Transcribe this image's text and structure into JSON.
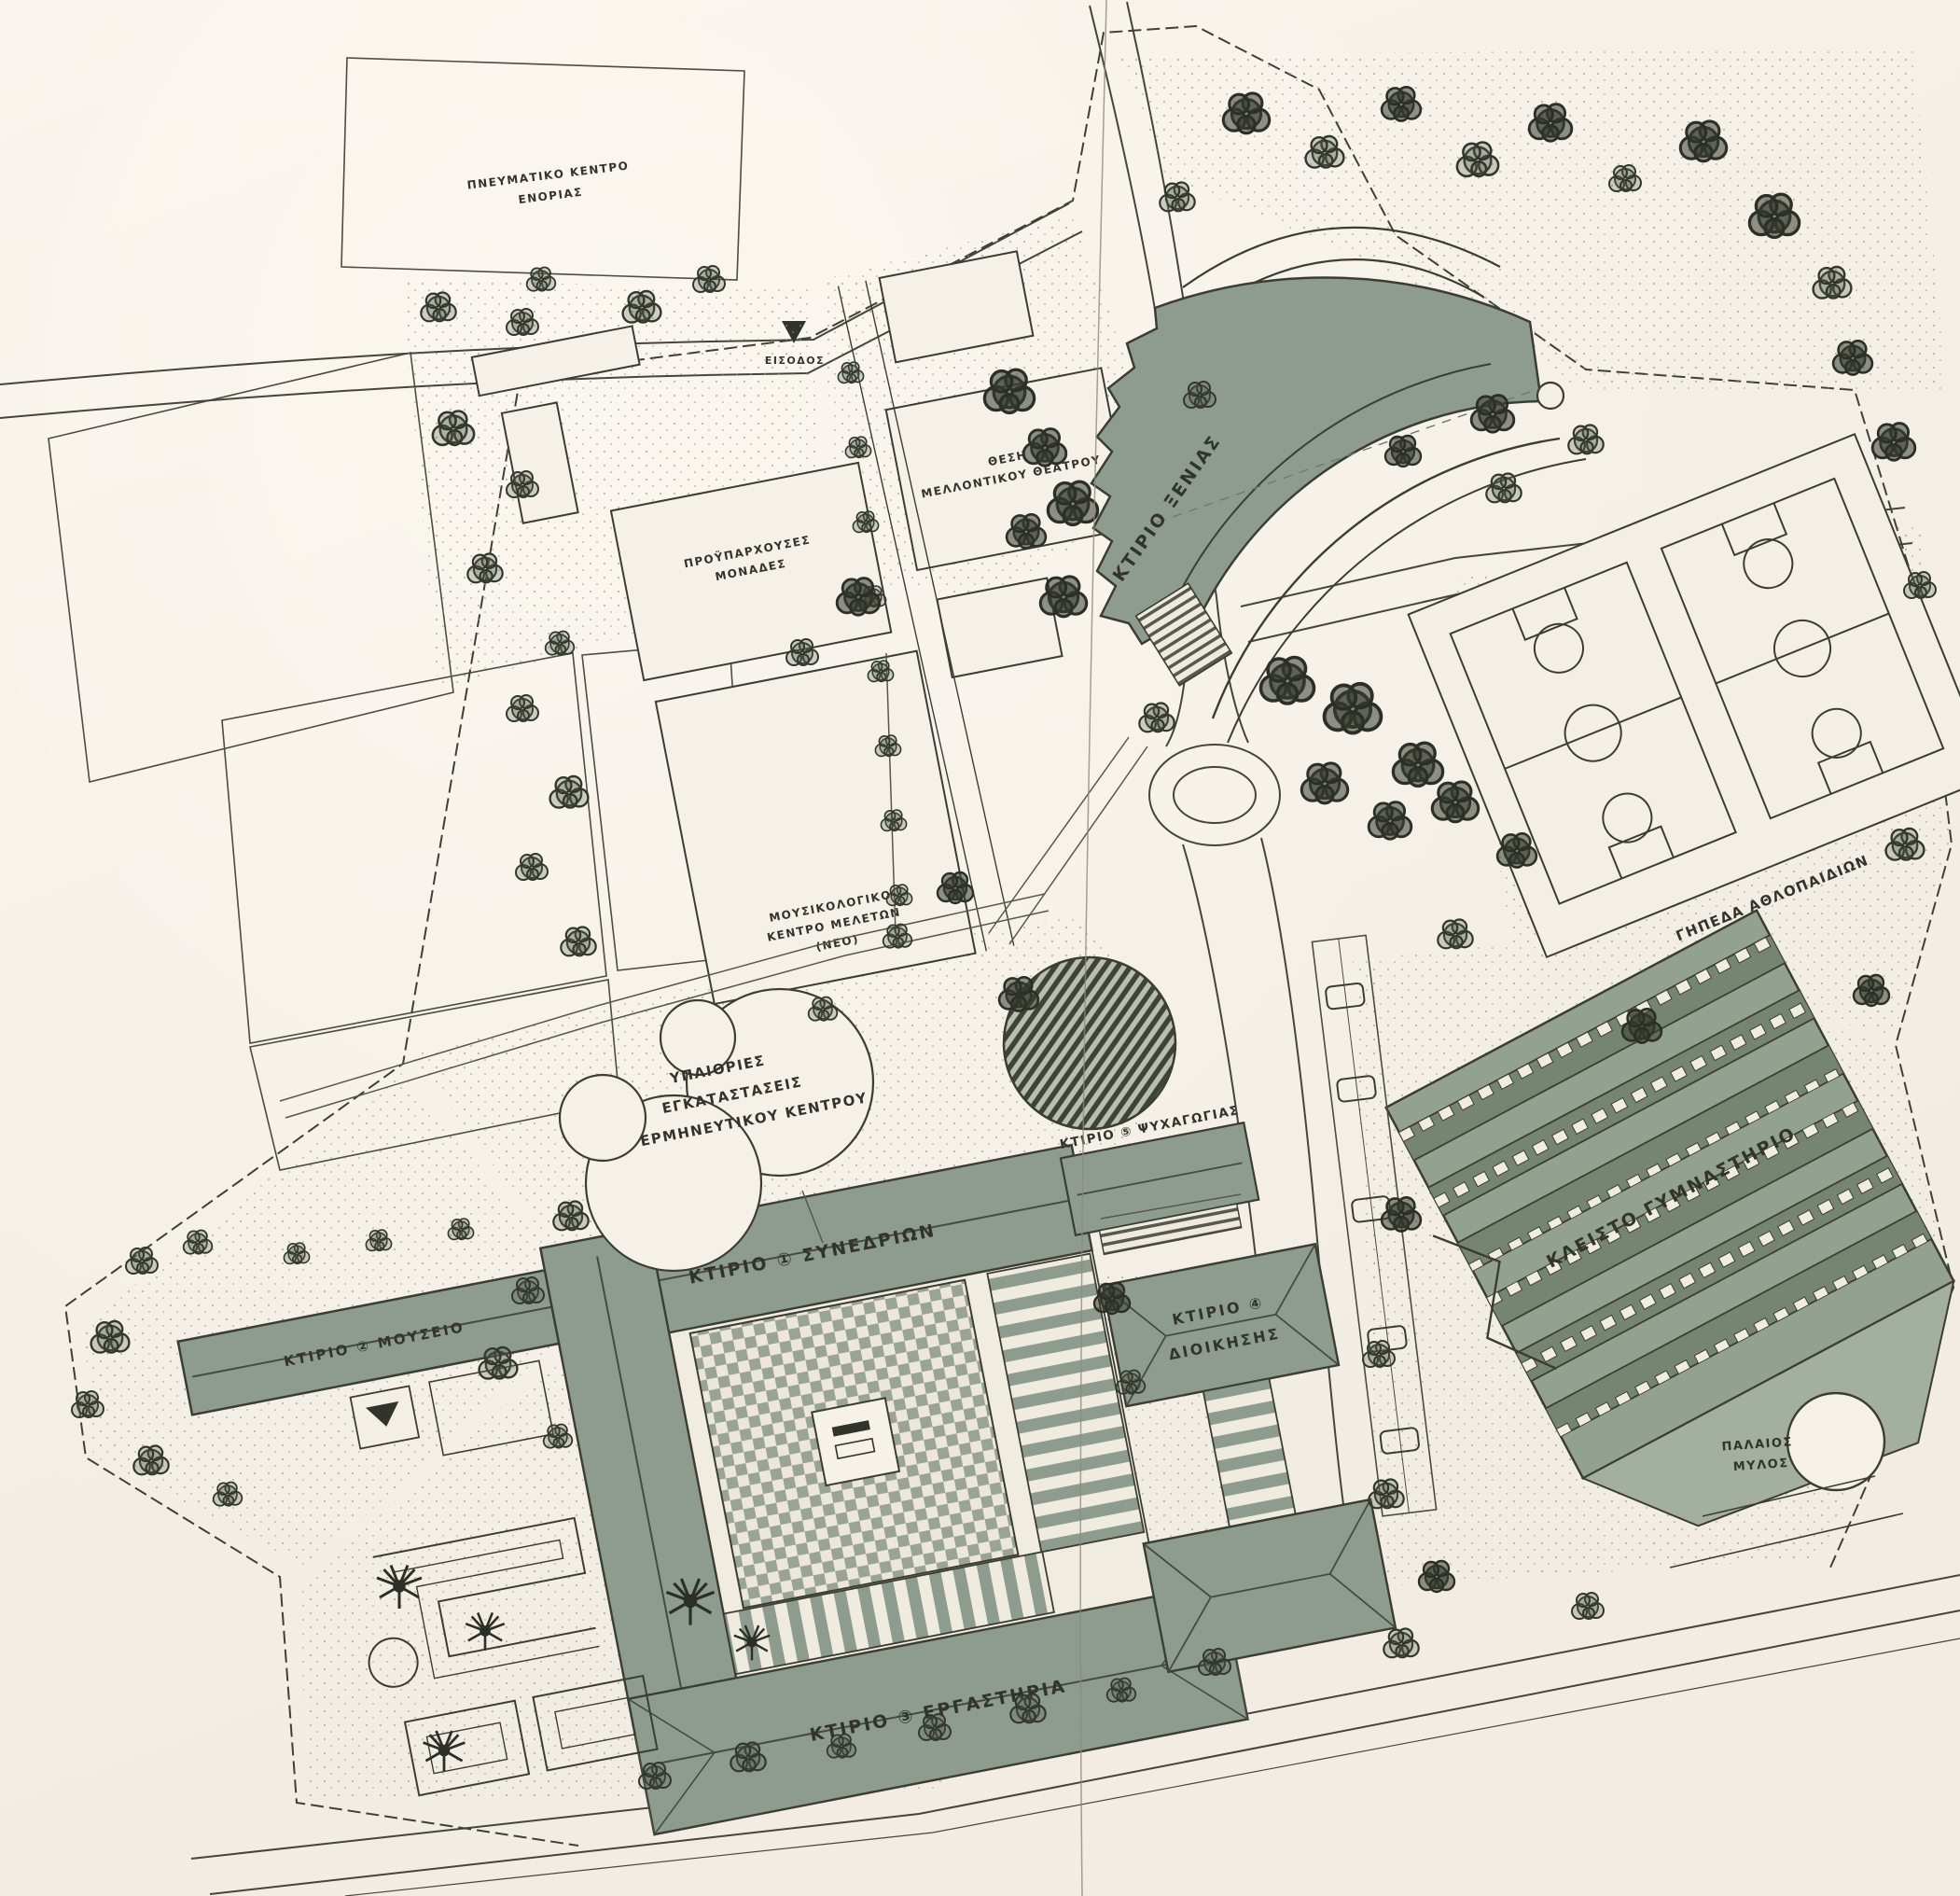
{
  "document": {
    "type": "architectural-site-plan-scan",
    "orientation_note": "campus master plan, buildings rotated ~-11deg"
  },
  "palette": {
    "paper": "#f5f0e7",
    "ink": "#3b3d33",
    "roof_sage": "#8e9c90",
    "roof_sage_dark": "#76856f",
    "roof_sage_light": "#a3af9f",
    "plaza_light": "#ece7da",
    "stipple": "#8d9286"
  },
  "plan": {
    "labels": {
      "xenia": "ΚΤΙΡΙΟ ΞΕΝΙΑΣ",
      "museum": "ΚΤΙΡΙΟ ② ΜΟΥΣΕΙΟ",
      "conference": "ΚΤΙΡΙΟ ① ΣΥΝΕΔΡΙΩΝ",
      "workshops": "ΚΤΙΡΙΟ ③ ΕΡΓΑΣΤΗΡΙΑ",
      "admin_line1": "ΚΤΙΡΙΟ ④",
      "admin_line2": "ΔΙΟΙΚΗΣΗΣ",
      "recreation": "ΚΤΙΡΙΟ ⑤ ΨΥΧΑΓΩΓΙΑΣ",
      "gym": "ΚΛΕΙΣΤΟ ΓΥΜΝΑΣΤΗΡΙΟ",
      "courts": "ΓΗΠΕΔΑ ΑΘΛΟΠΑΙΔΙΩΝ",
      "mill_line1": "ΠΑΛΑΙΟΣ",
      "mill_line2": "ΜΥΛΟΣ",
      "openair_line1": "ΥΠΑΙΘΡΙΕΣ",
      "openair_line2": "ΕΓΚΑΤΑΣΤΑΣΕΙΣ",
      "openair_line3": "ΕΡΜΗΝΕΥΤΙΚΟΥ ΚΕΝΤΡΟΥ",
      "hostel_line1": "ΠΡΟΫΠΑΡΧΟΥΣΕΣ",
      "hostel_line2": "ΜΟΝΑΔΕΣ",
      "theatre_site_line1": "ΘΕΣΗ",
      "theatre_site_line2": "ΜΕΛΛΟΝΤΙΚΟΥ ΘΕΑΤΡΟΥ",
      "music_line1": "ΜΟΥΣΙΚΟΛΟΓΙΚΟ",
      "music_line2": "ΚΕΝΤΡΟ ΜΕΛΕΤΩΝ",
      "music_line3": "(ΝΕΟ)",
      "parish_line1": "ΠΝΕΥΜΑΤΙΚΟ ΚΕΝΤΡΟ",
      "parish_line2": "ΕΝΟΡΙΑΣ",
      "entrance": "ΕΙΣΟΔΟΣ"
    }
  }
}
